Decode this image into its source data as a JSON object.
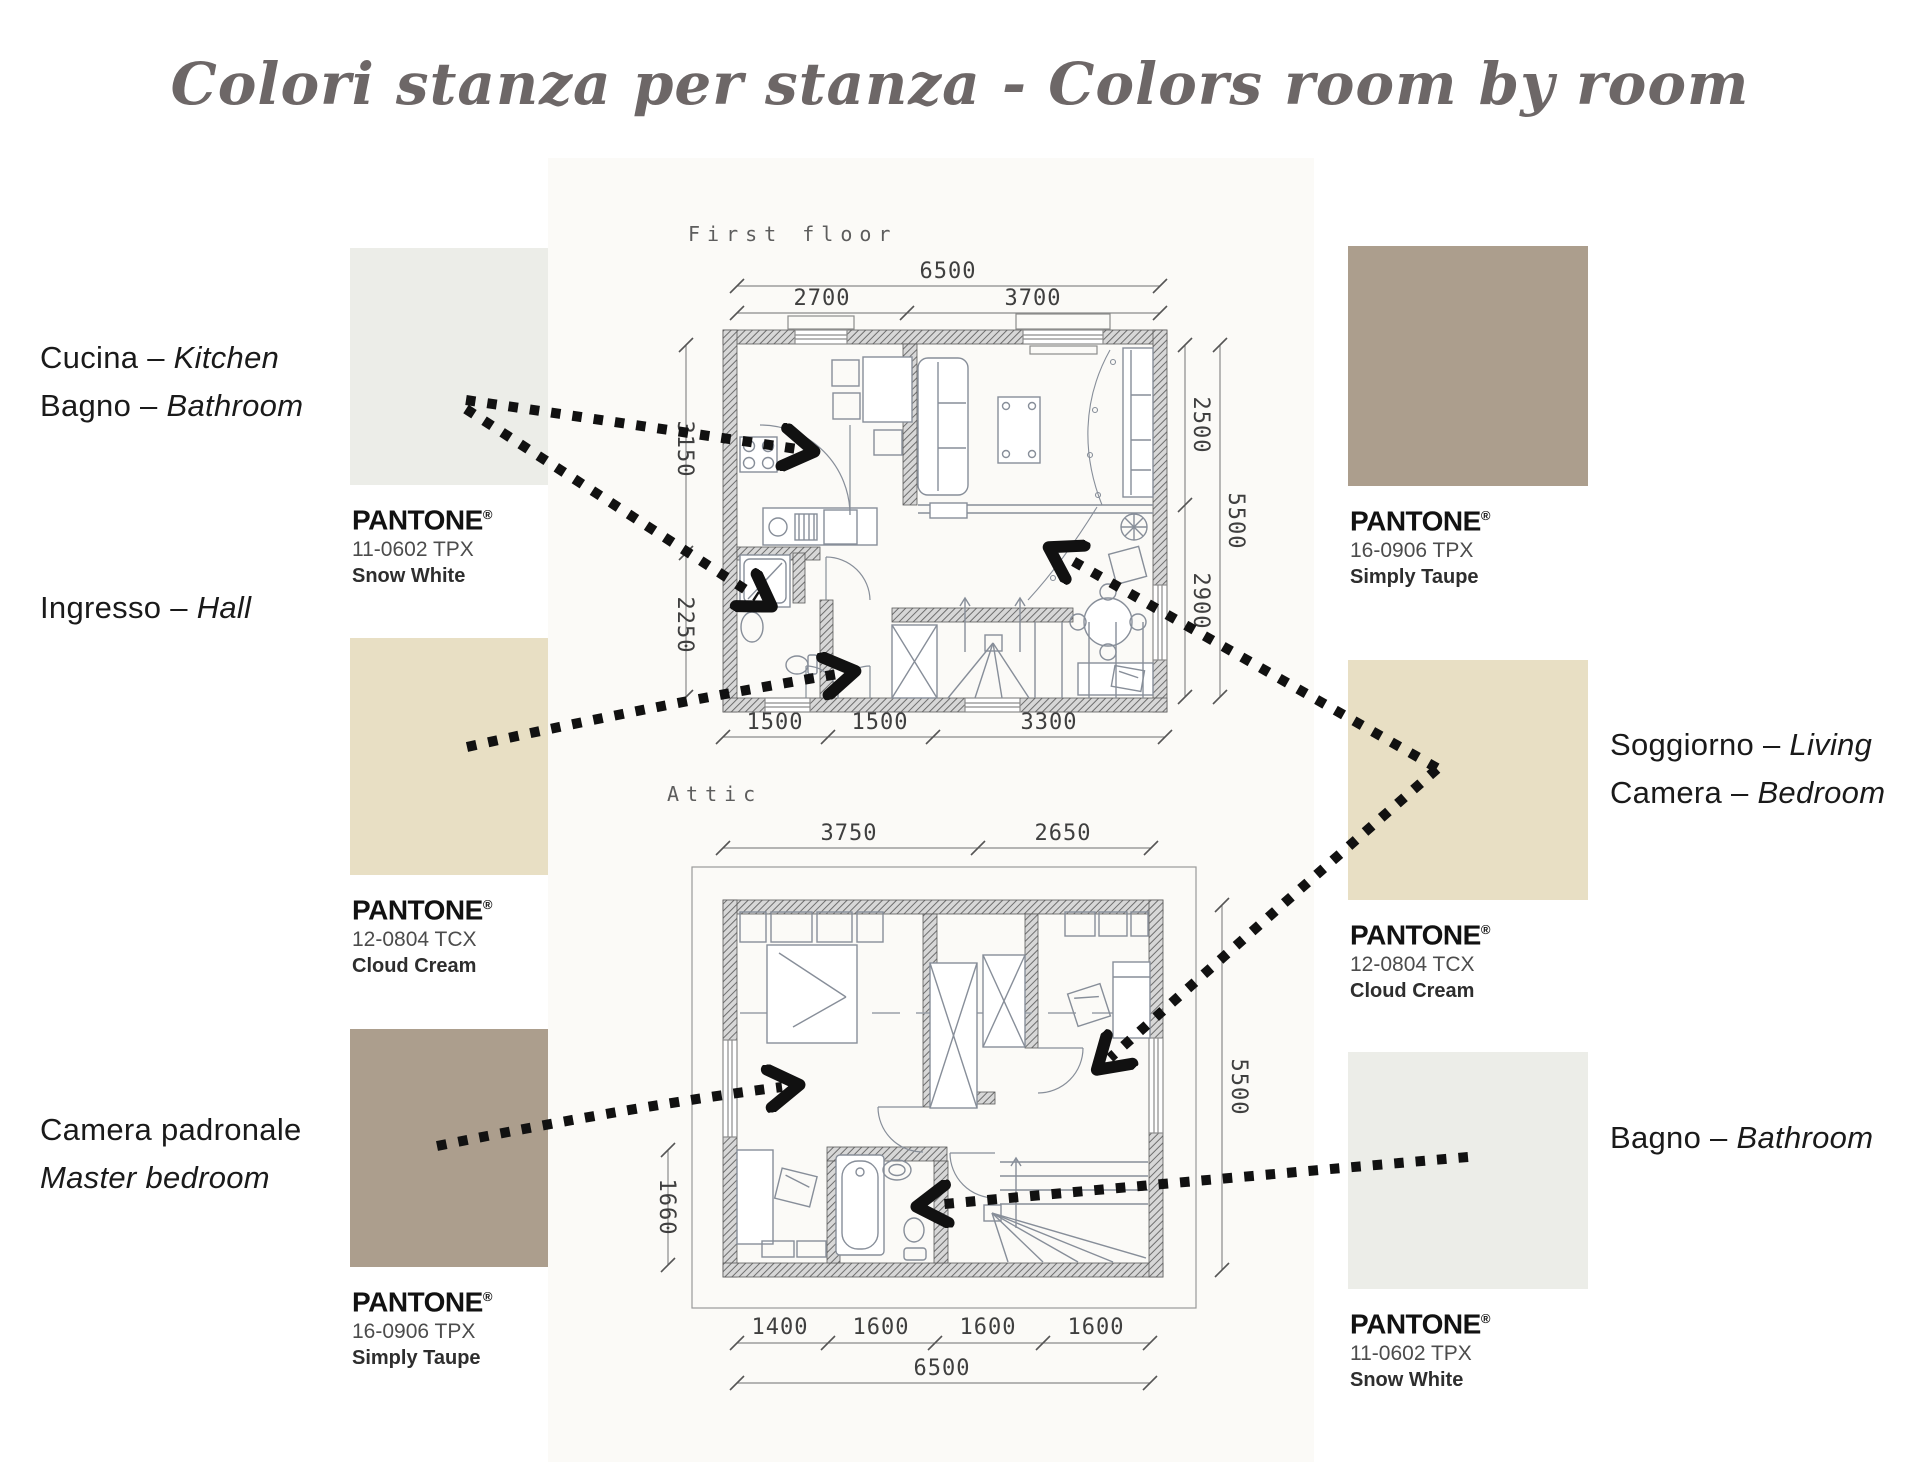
{
  "title": "Colori stanza per stanza - Colors room by room",
  "pantone": {
    "word": "PANTONE",
    "reg": "®"
  },
  "palette": {
    "snow_white": {
      "code": "11-0602 TPX",
      "name": "Snow White",
      "hex": "#ECEDE8"
    },
    "cloud_cream": {
      "code": "12-0804 TCX",
      "name": "Cloud Cream",
      "hex": "#E8DFC4"
    },
    "simply_taupe": {
      "code": "16-0906 TPX",
      "name": "Simply Taupe",
      "hex": "#AC9E8D"
    }
  },
  "room_labels": {
    "kitchen_bath": {
      "line1": {
        "regular": "Cucina –",
        "italic": "Kitchen"
      },
      "line2": {
        "regular": "Bagno –",
        "italic": "Bathroom"
      }
    },
    "hall": {
      "line1": {
        "regular": "Ingresso –",
        "italic": "Hall"
      }
    },
    "master": {
      "line1": {
        "regular": "Camera  padronale",
        "italic": ""
      },
      "line2": {
        "regular": "",
        "italic": "Master bedroom"
      }
    },
    "living_bedroom": {
      "line1": {
        "regular": "Soggiorno –",
        "italic": "Living"
      },
      "line2": {
        "regular": "Camera –",
        "italic": "Bedroom"
      }
    },
    "bath_attic": {
      "line1": {
        "regular": "Bagno –",
        "italic": "Bathroom"
      }
    }
  },
  "plans": {
    "first": {
      "name": "First floor",
      "dim_total_top": "6500",
      "dim_top": [
        "2700",
        "3700"
      ],
      "dim_left": [
        "3150",
        "2250"
      ],
      "dim_right": [
        "2500",
        "2900",
        "5500"
      ],
      "dim_bottom": [
        "1500",
        "1500",
        "3300"
      ]
    },
    "attic": {
      "name": "Attic",
      "dim_top": [
        "3750",
        "2650"
      ],
      "dim_left": "1660",
      "dim_right": "5500",
      "dim_bottom": [
        "1400",
        "1600",
        "1600",
        "1600"
      ],
      "dim_total_bottom": "6500"
    }
  }
}
